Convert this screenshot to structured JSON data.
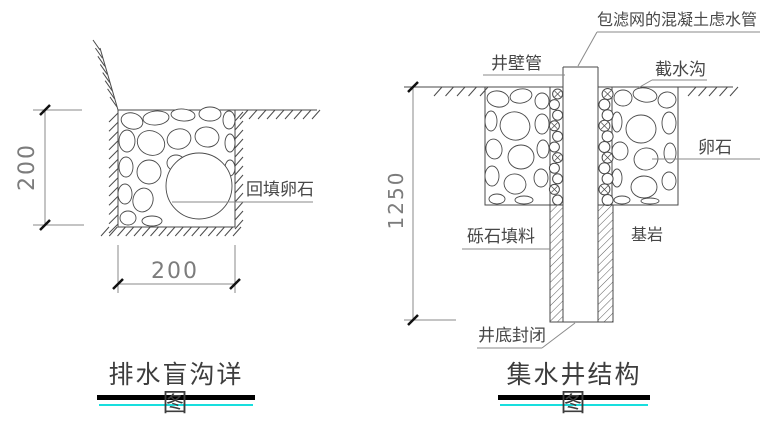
{
  "left_drawing": {
    "title": "排水盲沟详图",
    "dim_depth": "200",
    "dim_width": "200",
    "label_backfill_pebble": "回填卵石"
  },
  "right_drawing": {
    "title": "集水井结构图",
    "dim_depth": "1250",
    "label_filter_pipe": "包滤网的混凝土虑水管",
    "label_well_wall_pipe": "井壁管",
    "label_intercepting_ditch": "截水沟",
    "label_pebble": "卵石",
    "label_gravel_fill": "砾石填料",
    "label_bedrock": "基岩",
    "label_well_bottom_sealed": "井底封闭"
  },
  "colors": {
    "line": "#4a4a4a",
    "dim_line": "#8a8a8a",
    "tick": "#111111",
    "title_bar": "#000000",
    "title_accent": "#18dede"
  }
}
